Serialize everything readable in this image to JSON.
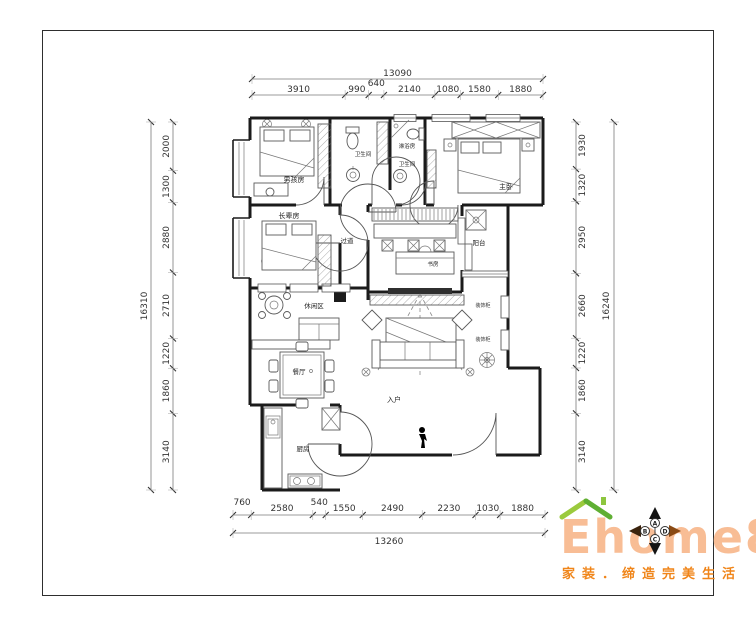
{
  "dimensions": {
    "top": {
      "total": "13090",
      "segments": [
        "3910",
        "990",
        "640",
        "2140",
        "1080",
        "1580",
        "1880"
      ]
    },
    "bottom": {
      "total": "13260",
      "segments": [
        "760",
        "2580",
        "540",
        "1550",
        "2490",
        "2230",
        "1030",
        "1880"
      ]
    },
    "left": {
      "total": "16310",
      "segments": [
        "2000",
        "1300",
        "2880",
        "2710",
        "1220",
        "1860",
        "3140"
      ]
    },
    "right": {
      "total": "16240",
      "segments": [
        "1930",
        "1320",
        "2950",
        "2660",
        "1220",
        "1860",
        "3140"
      ]
    }
  },
  "rooms": {
    "boys_room": "男孩房",
    "bathroom_1": "卫生间",
    "shower_room": "淋浴房",
    "bathroom_2": "卫生间",
    "master_bedroom": "主卧",
    "elders_room": "长辈房",
    "hallway": "过道",
    "balcony": "阳台",
    "study": "书房",
    "leisure_area": "休闲区",
    "dining_room": "餐厅",
    "kitchen": "厨房",
    "entry": "入户",
    "decor_cabinet_1": "装饰柜",
    "decor_cabinet_2": "装饰柜"
  },
  "logo": {
    "brand": "Ehome8",
    "slogan": "家装．缔造完美生活",
    "compass": {
      "north": "A",
      "west": "B",
      "south": "C",
      "east": "D"
    }
  },
  "colors": {
    "brand_text": "#f8bd95",
    "slogan_text": "#f08519",
    "roof_left": "#9bca3d",
    "roof_right": "#5faf33",
    "wall": "#1b1b1b",
    "dim_text": "#333333"
  }
}
